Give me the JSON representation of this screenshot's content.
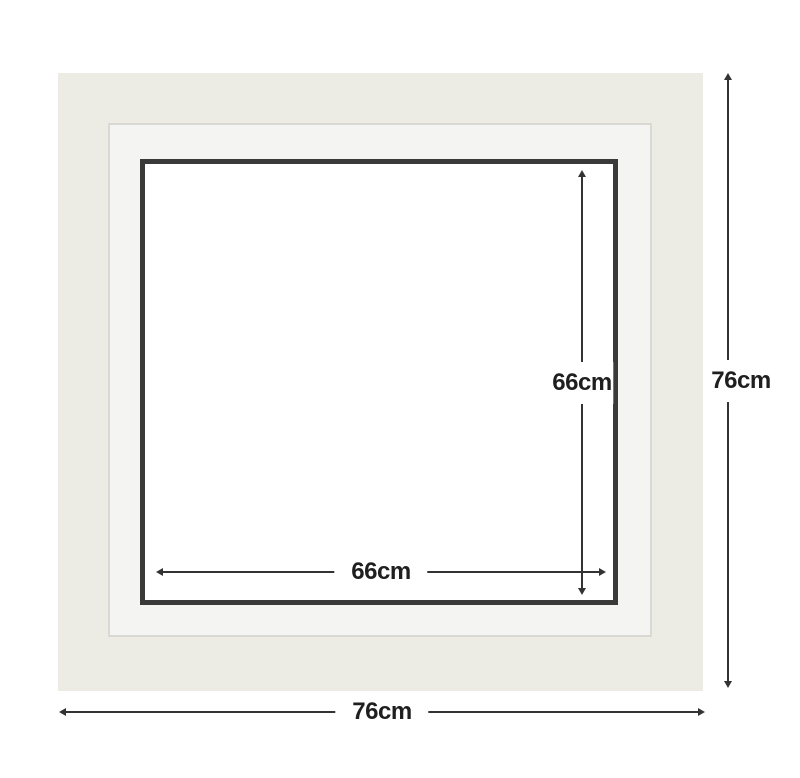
{
  "diagram": {
    "colors": {
      "background": "#FFFFFF",
      "outer_frame": "#ECEBE4",
      "mat_board": "#F4F4F2",
      "mat_edge": "#D8D8D5",
      "opening_border": "#3A3A3A",
      "opening_fill": "#FFFFFF",
      "dimension_line": "#333333",
      "label_text": "#1F1F1F"
    },
    "dimensions": {
      "opening_height": {
        "label": "66cm"
      },
      "opening_width": {
        "label": "66cm"
      },
      "frame_height": {
        "label": "76cm"
      },
      "frame_width": {
        "label": "76cm"
      }
    }
  }
}
